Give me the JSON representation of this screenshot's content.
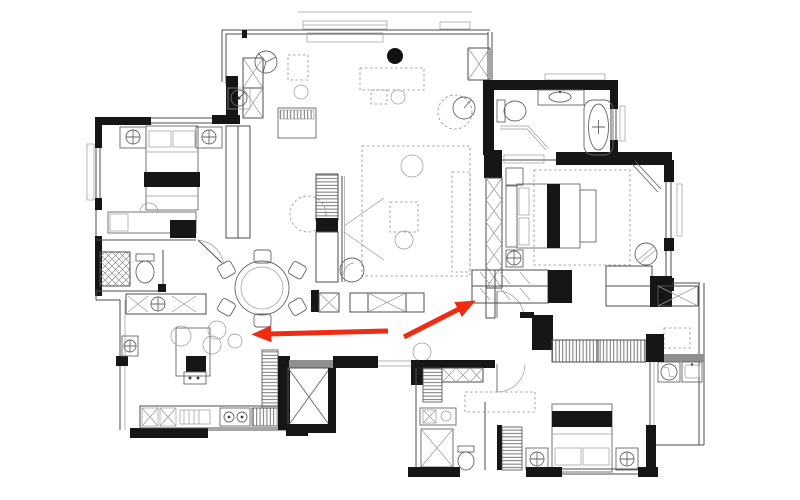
{
  "meta": {
    "view": "apartment-floor-plan-top-view",
    "style": "black-and-white architectural drawing with red annotation arrows",
    "visible_text": ""
  },
  "colors": {
    "background": "#ffffff",
    "walls": "#161616",
    "lines": "#4d4d4d",
    "light_lines": "#9a9a9a",
    "gray_fill": "#8f8f8f",
    "accent_red": "#ee2b13"
  },
  "annotations": {
    "arrows": [
      {
        "id": "arrow-left",
        "direction": "pointing-left",
        "x1": 388,
        "y1": 331,
        "x2": 268,
        "y2": 334,
        "color": "#ee2b13"
      },
      {
        "id": "arrow-up-right",
        "direction": "pointing-upper-right",
        "x1": 404,
        "y1": 337,
        "x2": 461,
        "y2": 308,
        "color": "#ee2b13"
      }
    ]
  },
  "plan": {
    "rooms": [
      {
        "name": "bedroom-top-left",
        "symbols": [
          "double-bed",
          "pillows",
          "nightstand-left",
          "nightstand-right",
          "ceiling-lamp-left",
          "ceiling-lamp-right",
          "wardrobe-shelving",
          "desk",
          "side-table",
          "window-left",
          "window-top"
        ]
      },
      {
        "name": "study-lounge-top-center",
        "symbols": [
          "ceiling-fan",
          "piano",
          "shelf-sideboard",
          "dashed-desk",
          "stool",
          "black-pendant",
          "thermostat-dial",
          "structural-column-x",
          "window-top"
        ]
      },
      {
        "name": "living-room-center",
        "symbols": [
          "tv-media-cabinet",
          "projection-beam",
          "hanging-chair-dashed",
          "area-rug-dashed",
          "sofa-dashed",
          "coffee-table-dashed",
          "pouf",
          "low-cabinet-row"
        ]
      },
      {
        "name": "dining-area",
        "symbols": [
          "round-table",
          "six-chairs",
          "pendant-lamps"
        ]
      },
      {
        "name": "kitchen-bottom-left",
        "symbols": [
          "island",
          "bar-stools",
          "double-sink-unit",
          "cooktop-two-burners",
          "counter-run",
          "tall-pantry-shelving",
          "wall-basin"
        ]
      },
      {
        "name": "small-bath-left",
        "symbols": [
          "toilet",
          "hatched-shower-closet"
        ]
      },
      {
        "name": "elevator-shaft",
        "symbols": [
          "x-crossed-shaft",
          "gray-threshold"
        ]
      },
      {
        "name": "entry-hall",
        "symbols": [
          "door-opening",
          "low-cabinets",
          "gray-threshold"
        ]
      },
      {
        "name": "bathroom-top-right",
        "symbols": [
          "bathtub",
          "toilet",
          "vanity-sink",
          "shower-screen",
          "window-right"
        ]
      },
      {
        "name": "master-bedroom-right",
        "symbols": [
          "double-bed",
          "headboard",
          "bench",
          "nightstand",
          "ceiling-lamp",
          "armchair",
          "floor-mirror",
          "wardrobe-shelving",
          "area-rug-dashed",
          "window-right",
          "door-arc"
        ]
      },
      {
        "name": "bedroom-bottom",
        "symbols": [
          "double-bed",
          "pillows",
          "nightstand-left",
          "nightstand-right",
          "ceiling-lamp-left",
          "ceiling-lamp-right",
          "wardrobe-shelving",
          "rug-dashed",
          "door-arc",
          "window-bottom"
        ]
      },
      {
        "name": "bathroom-bottom",
        "symbols": [
          "shower-x-cabin",
          "toilet",
          "vanity-sink",
          "linen-closet-hatched"
        ]
      },
      {
        "name": "laundry-balcony-right",
        "symbols": [
          "washing-machine",
          "utility-sink",
          "x-crossed-closet",
          "small-desk-dashed",
          "glass-window-wall",
          "gray-threshold"
        ]
      }
    ]
  }
}
